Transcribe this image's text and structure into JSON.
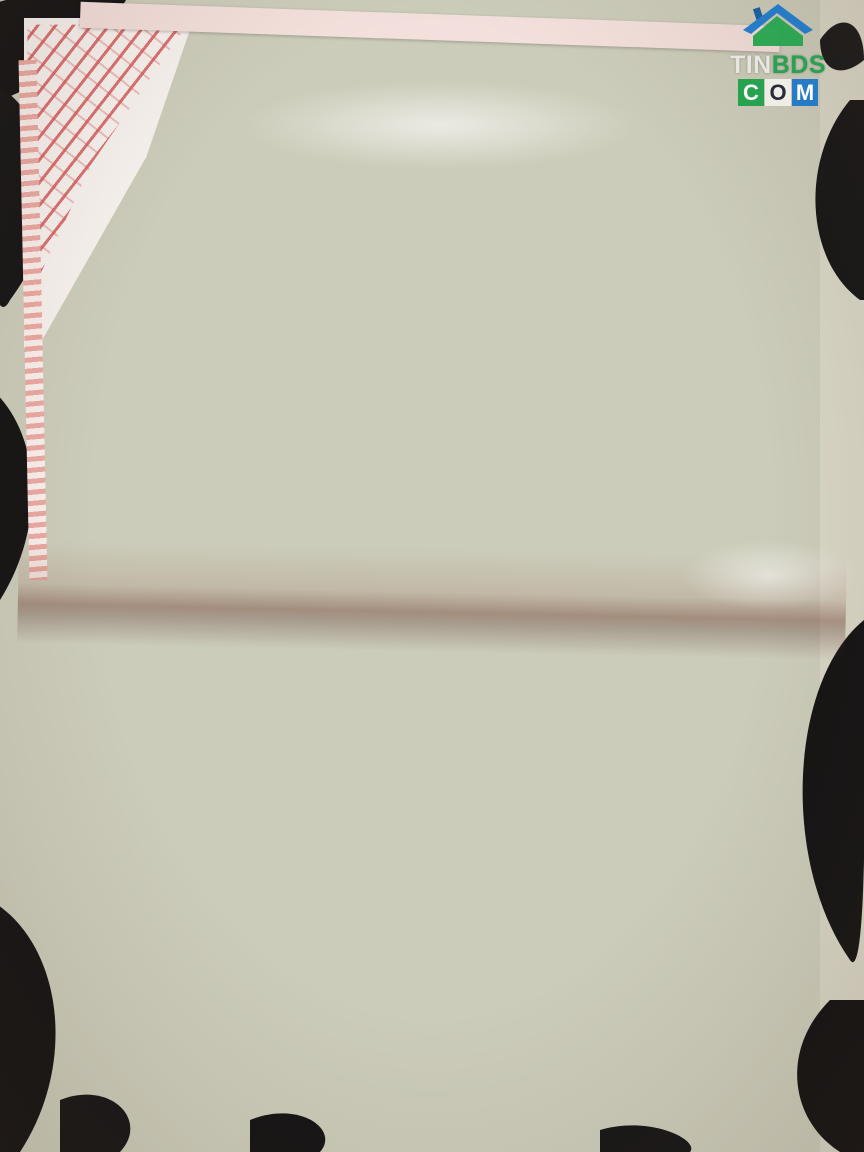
{
  "watermark": {
    "tin": "TIN",
    "bds": "BDS",
    "c": "C",
    "o": "O",
    "m": "M"
  },
  "plan_page": {
    "heading": "III. Sơ đồ thửa đất, nhà ở và tài sản khác gắn liền với đất",
    "north_label": "B",
    "caption_line1": "Mặt bằng Tầng 1, Chung cư ORIENT APARTMENT",
    "caption_line2": "(Số tầng: 1 hầm + 17 tầng + mái che thang)",
    "change_table": {
      "col1": "Nội dung thay đổi và cơ sở pháp lý",
      "col2": "Xác nhận của cơ quan có thẩm quyền"
    }
  },
  "info_page": {
    "heading": "II . Thửa đất, nhà ở và tài sản khác gắn liền với đất",
    "sub1": "1. Thửa đất",
    "items": [
      "a) Thửa đất số:  18  , tờ bản đồ số:  01",
      "b) Địa chỉ: Số 331, Bến Vân Đồn, phường 1, quận 4",
      "c) Diện tích: 3.013,7 m² , (bằng chữ:) Ba nghìn không trăm mười ba phẩy bảy mét vuông",
      "d) Hình thức sử dụng: riêng:  Không  m² , chung:  3.013,7  m²",
      "đ) Mục đích sử dụng:  Đất ở đô thị",
      "e) Thời hạn sử dụng:  Lâu dài",
      "g) Nguồn gốc sử dụng:  Nhà nước giao đất có thu tiền sử dụng đất"
    ],
    "sub2": "2. Nhà ở:  -/-",
    "sub3": "3. Công trình xây dựng khác",
    "sub3a": "a. Tên công trình: 1.05 Chung cư Orient Apartment số 331, Bến Vân Đồn, phường 1, quận 4",
    "table_title": "b. Thông tin chi tiết về công trình",
    "table": {
      "headers": [
        "Hạng mục công trình:",
        "Diện tích xây dựng (m²)",
        "Diện tích sàn ( m² )",
        "Kết cấu chủ yếu",
        "Cấp công trình",
        "Số tầng",
        "Năm HT xây dựng",
        "Thời hạn sở hữu"
      ],
      "row": [
        "Số 1.05 Khu thương mại và văn phòng",
        "-/-",
        "210.17",
        "Vách gạch, sàn BTCT, mái BTCT",
        "II",
        "1/17",
        "2010",
        "-/-"
      ]
    },
    "sub4": "4. Rừng sản xuất là rừng trồng:  Không có",
    "sub5": "5. Cây lâu năm :  Không có",
    "sub6": "6. Ghi chú",
    "note1": "Chung cư Orient Apartment số 331 Bến Vân Đồn đã được Sở Tài nguyên và Môi trường thành phố",
    "note2": "cấp GCNQSDĐ số T00438/2a ngày 29/10/2008",
    "note3": "- Kích thước và diện tích được tính lọt lòng ( thông thủy )",
    "legend": [
      {
        "label": ": Ranh đất"
      },
      {
        "label": ": Ranh lộ giới"
      },
      {
        "label": ": Tim đường"
      },
      {
        "label": ": Lề đường"
      },
      {
        "label": ": Khu thương mại và văn phòng"
      }
    ],
    "sign_block": {
      "date_prefix": "Quận 4,  Ngày",
      "date_day": "29",
      "date_mid1": "tháng",
      "date_month": "11",
      "date_mid2": "năm",
      "date_year": "2013",
      "org": "TM. ỦY BAN NHÂN DÂN QUẬN 4",
      "title1": "KT.CHỦ TỊCH",
      "title2": "PHÓ CHỦ TỊCH",
      "signer": "Trần Hoàng Quân"
    },
    "seal": {
      "ring_top": "THÀNH PHỐ HỒ CHÍ MINH",
      "bottom": "QUẬN 4"
    },
    "book_no": "Số vào sổ cấp GCN:   CH20314"
  },
  "colors": {
    "seal_red": "#cf4a3c",
    "paper_pink": "#efe2df",
    "logo_green": "#1fa24a",
    "logo_blue": "#1f78c8"
  }
}
